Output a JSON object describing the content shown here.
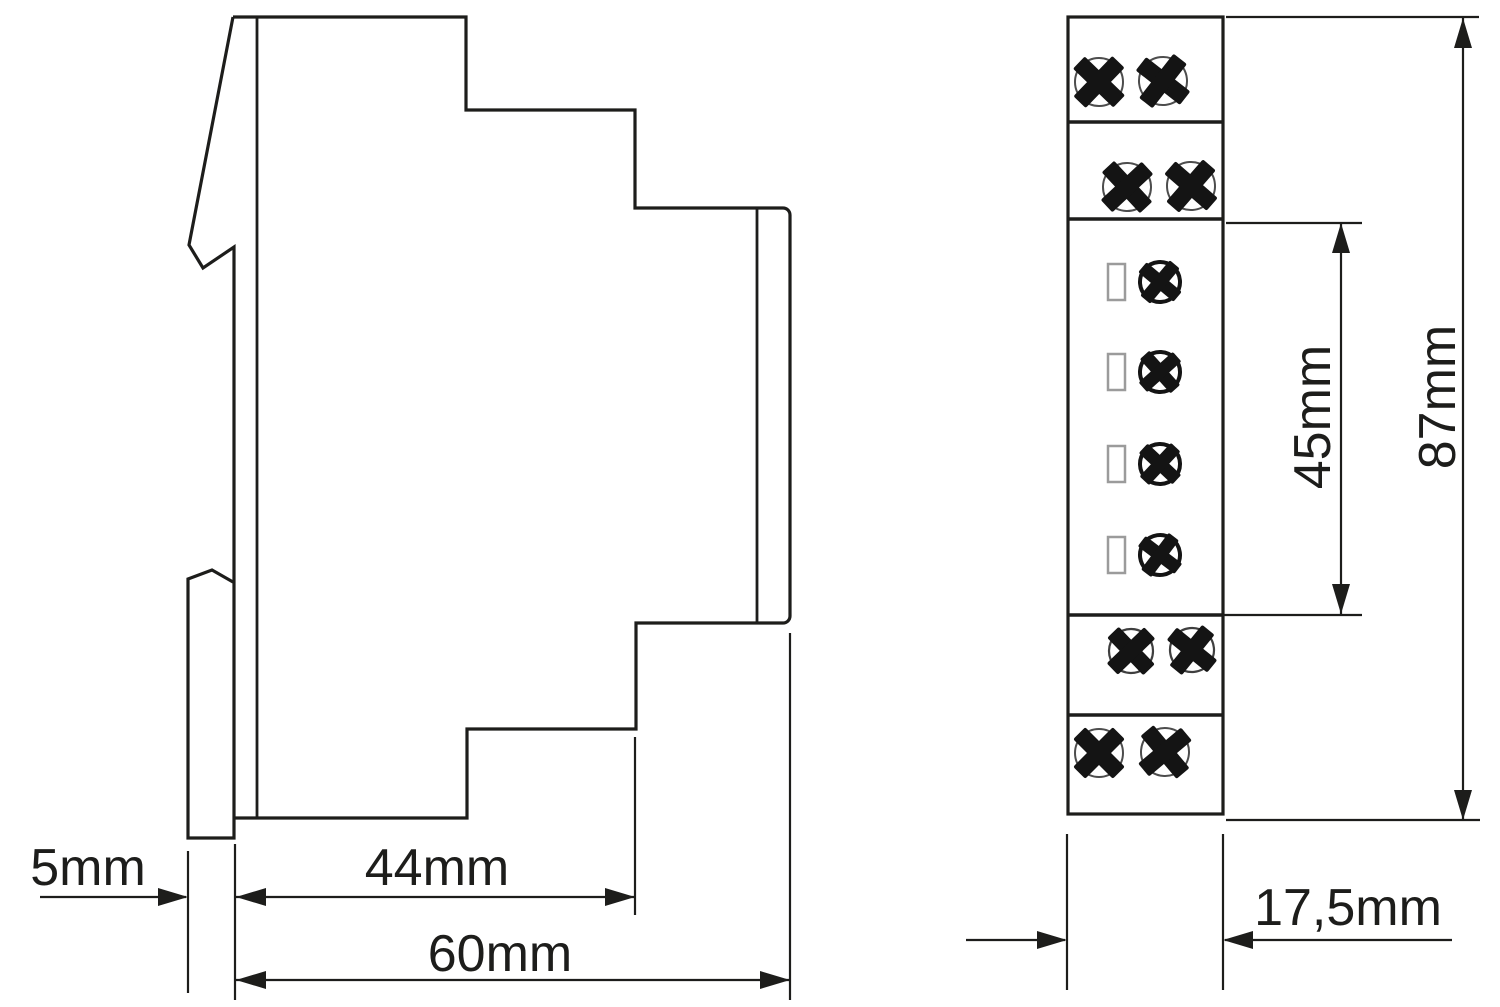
{
  "style": {
    "background": "#ffffff",
    "line_color": "#1d1d1b"
  },
  "side_view": {
    "dimensions": {
      "clip_depth": "5mm",
      "body_depth": "44mm",
      "total_depth": "60mm"
    }
  },
  "front_view": {
    "dimensions": {
      "terminal_section_height": "45mm",
      "total_height": "87mm",
      "module_width": "17,5mm"
    }
  }
}
